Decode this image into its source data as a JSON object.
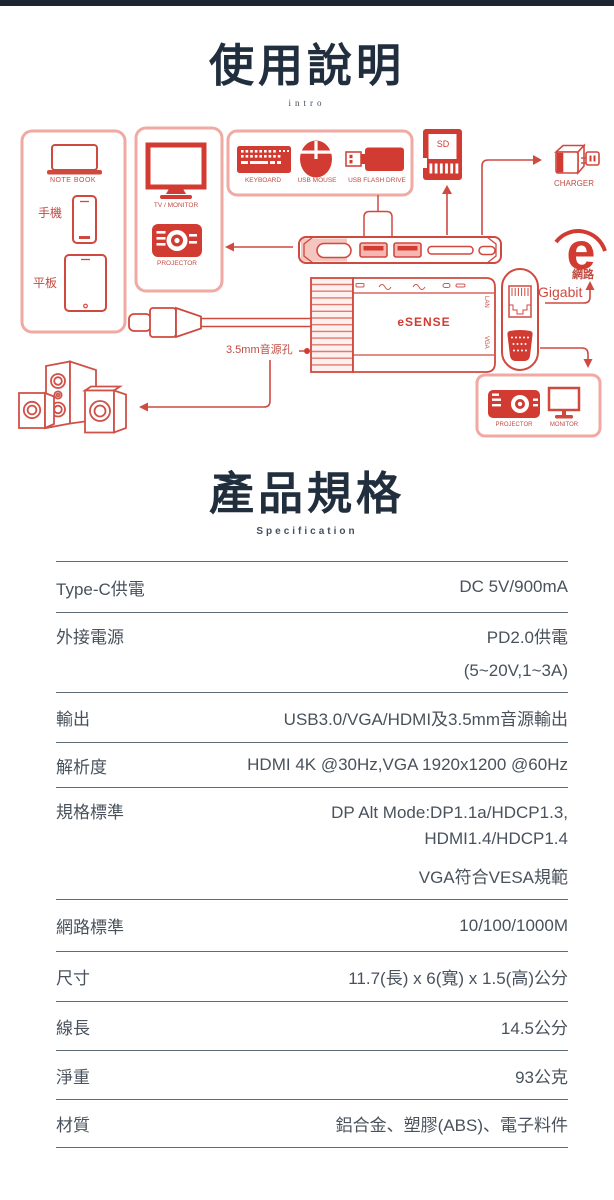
{
  "theme": {
    "accent_red": "#d23b31",
    "stroke_red": "#cf4a41",
    "panel_border": "#f0aaa3",
    "navy": "#202e3d",
    "table_text": "#49525c",
    "table_line": "#5f6b75",
    "topbar": "#1c2531"
  },
  "intro_section": {
    "title": "使用說明",
    "subtitle": "intro"
  },
  "diagram": {
    "source_panel": {
      "notebook": "NOTE BOOK",
      "phone": "手機",
      "tablet": "平板"
    },
    "display_panel": {
      "tv": "TV / MONITOR",
      "projector": "PROJECTOR"
    },
    "peripherals_panel": {
      "keyboard": "KEYBOARD",
      "mouse": "USB MOUSE",
      "flash_drive": "USB FLASH DRIVE"
    },
    "sd_card": "SD",
    "charger": "CHARGER",
    "network": {
      "label": "網路",
      "speed": "Gigabit"
    },
    "hub": {
      "brand": "eSENSE",
      "lan": "LAN",
      "vga": "VGA"
    },
    "audio_jack": "3.5mm音源孔",
    "output_panel": {
      "projector": "PROJECTOR",
      "monitor": "MONITOR"
    }
  },
  "spec_section": {
    "title": "產品規格",
    "subtitle": "Specification",
    "rows": [
      {
        "label": "Type-C供電",
        "value": "DC 5V/900mA"
      },
      {
        "label": "外接電源",
        "value": "PD2.0供電",
        "value2": "(5~20V,1~3A)"
      },
      {
        "label": "輸出",
        "value": "USB3.0/VGA/HDMI及3.5mm音源輸出"
      },
      {
        "label": "解析度",
        "value": "HDMI 4K @30Hz,VGA 1920x1200 @60Hz"
      },
      {
        "label": "規格標準",
        "value": "DP Alt Mode:DP1.1a/HDCP1.3,",
        "value2": "HDMI1.4/HDCP1.4",
        "value3": "VGA符合VESA規範"
      },
      {
        "label": "網路標準",
        "value": "10/100/1000M"
      },
      {
        "label": "尺寸",
        "value": "11.7(長) x 6(寬) x 1.5(高)公分"
      },
      {
        "label": "線長",
        "value": "14.5公分"
      },
      {
        "label": "淨重",
        "value": "93公克"
      },
      {
        "label": "材質",
        "value": "鋁合金、塑膠(ABS)、電子料件"
      }
    ]
  }
}
